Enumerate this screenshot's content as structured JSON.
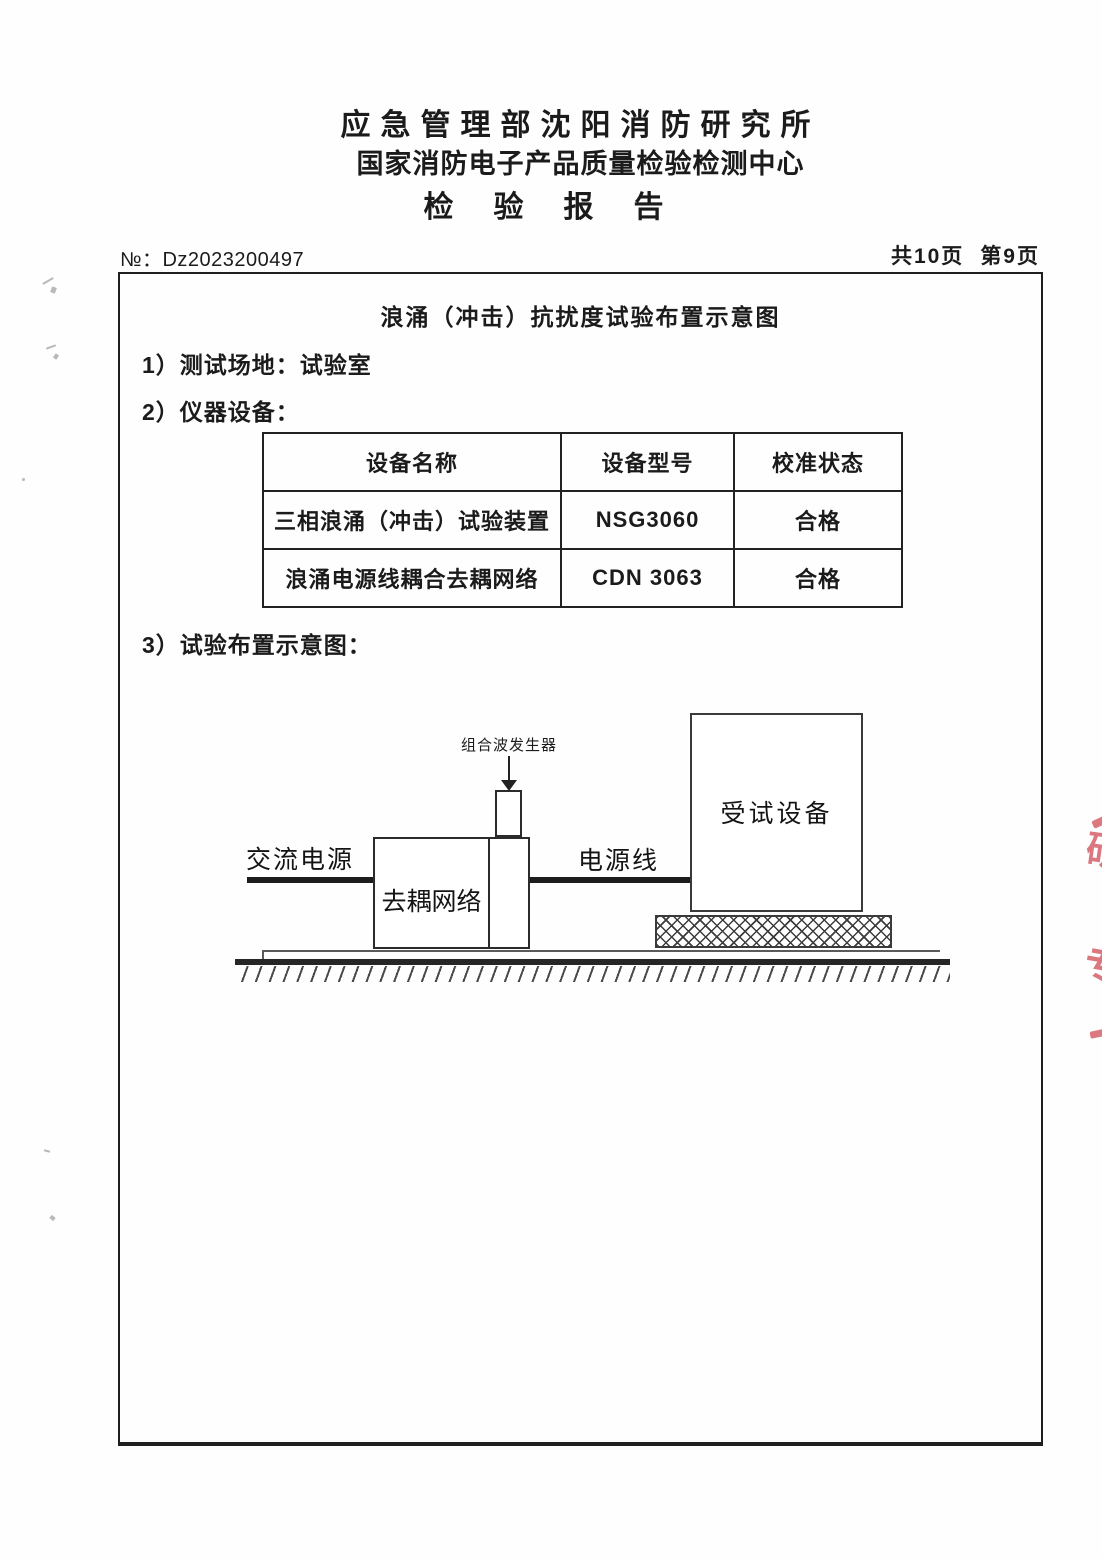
{
  "header": {
    "line1": "应急管理部沈阳消防研究所",
    "line2": "国家消防电子产品质量检验检测中心",
    "line3": "检验报告"
  },
  "meta": {
    "doc_no_label": "№：",
    "doc_no": "Dz2023200497",
    "pages_total": "共10页",
    "page_current": "第9页"
  },
  "report": {
    "title": "浪涌（冲击）抗扰度试验布置示意图",
    "items": {
      "item1": "1）测试场地：试验室",
      "item2": "2）仪器设备：",
      "item3": "3）试验布置示意图："
    },
    "equipment_table": {
      "headers": [
        "设备名称",
        "设备型号",
        "校准状态"
      ],
      "rows": [
        [
          "三相浪涌（冲击）试验装置",
          "NSG3060",
          "合格"
        ],
        [
          "浪涌电源线耦合去耦网络",
          "CDN 3063",
          "合格"
        ]
      ]
    },
    "diagram": {
      "generator_label": "组合波发生器",
      "ac_power_label": "交流电源",
      "decoupling_label": "去耦网络",
      "power_line_label": "电源线",
      "eut_label": "受试设备"
    }
  },
  "stamp": {
    "color": "#d5606a",
    "fragment1": "研",
    "fragment2": "（",
    "fragment3": "专"
  }
}
